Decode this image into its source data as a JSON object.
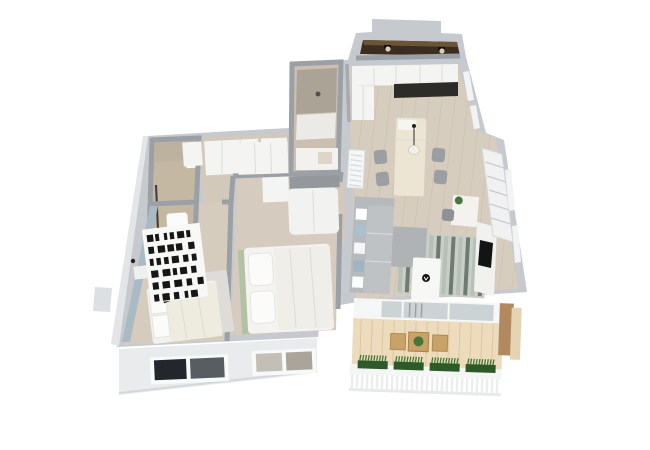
{
  "scene": {
    "type": "3d-isometric-floor-plan",
    "title": "Two-bedroom apartment 3D floor plan render",
    "background": "#ffffff",
    "view": "axonometric top-down, tilted"
  },
  "palette": {
    "wall_top": "#c6c9cd",
    "wall_side": "#9aa0a6",
    "wall_face": "#e9ebed",
    "floor_wood": "#d7cdbf",
    "bath_floor": "#c9c0b1",
    "loggia_brown": "#3b2e20",
    "loggia_brown_light": "#6a5539",
    "balcony_wood": "#ecdcbd",
    "balcony_wood_dark": "#c9a268",
    "railing_white": "#f4f5f5",
    "plant_green": "#47763a",
    "planter_green": "#2e5a2a",
    "rug_green": "#b2c2a2",
    "rug_base": "#c8cfc6",
    "rug_stripe": "#707a72",
    "accent_blue": "#a9bac5",
    "sofa_gray": "#bfc2c4",
    "furniture_white": "#f4f4f2",
    "countertop_dark": "#2e2c29",
    "tv_black": "#121416",
    "glass_pane": "#ccd3d5"
  },
  "rooms": [
    {
      "id": "loggia",
      "name": "Storage loggia",
      "floor": "dark brown",
      "features": [
        "two ceiling lights"
      ]
    },
    {
      "id": "kitchen",
      "name": "Kitchen / dining",
      "floor": "light wood",
      "features": [
        "white cabinets",
        "dark countertop",
        "island with pendant light",
        "four gray chairs",
        "radiator"
      ]
    },
    {
      "id": "shower-room",
      "name": "Shower room",
      "floor": "beige tile",
      "features": [
        "glass shower",
        "white vanity"
      ]
    },
    {
      "id": "bathroom",
      "name": "Bathroom",
      "floor": "beige tile",
      "features": [
        "toilet",
        "towel rail"
      ]
    },
    {
      "id": "hallway",
      "name": "Hallway",
      "floor": "light wood",
      "features": [
        "white wardrobes"
      ]
    },
    {
      "id": "bedroom-1",
      "name": "Bedroom 1",
      "floor": "light wood",
      "features": [
        "blue-gray accent wall",
        "bookshelf with black books",
        "double bed with black cushion",
        "gray rug",
        "nightstand"
      ]
    },
    {
      "id": "bedroom-2",
      "name": "Bedroom 2",
      "floor": "light wood",
      "features": [
        "white wardrobe",
        "gray-top dresser",
        "double bed",
        "green rug"
      ]
    },
    {
      "id": "living-room",
      "name": "Living room",
      "floor": "light wood",
      "features": [
        "gray corner sofa",
        "white and blue pillows",
        "striped rug",
        "white coffee table",
        "TV media wall",
        "tall shelving",
        "desk with plant",
        "office chair"
      ]
    },
    {
      "id": "balcony",
      "name": "Balcony / terrace",
      "floor": "wood decking",
      "features": [
        "glazed wall with curtain",
        "wooden table with plant",
        "two wooden chairs",
        "white railing",
        "four green planters"
      ]
    }
  ],
  "counts": {
    "balcony_planters": 4,
    "loggia_lights": 2,
    "sofa_pillows": 5,
    "island_chairs": 4
  }
}
